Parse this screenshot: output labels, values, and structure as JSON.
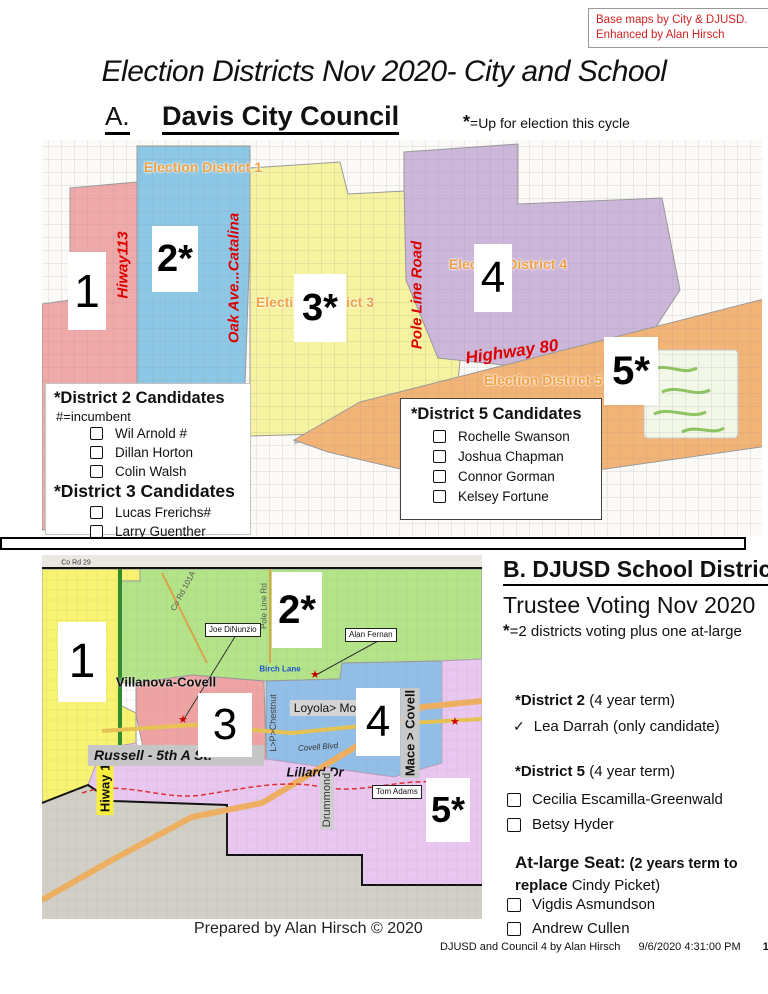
{
  "credit_box": {
    "line1": "Base maps by City & DJUSD.",
    "line2": "Enhanced by Alan Hirsch"
  },
  "title": "Election Districts Nov 2020- City and School",
  "icons": {
    "star": "★",
    "check": "✓"
  },
  "colors": {
    "credit_red": "#cc2222",
    "road_label_red": "#dd0000",
    "area_label_orange": "#f0a143",
    "council_districts": [
      "#efa9a9",
      "#8cc8e6",
      "#f5f2a0",
      "#ccb6da",
      "#f2b376"
    ],
    "school_districts": [
      "#f8f370",
      "#b4e488",
      "#f0a3a3",
      "#92bfe8",
      "#e9c7f0"
    ]
  },
  "section_a": {
    "label": "A.",
    "heading": "Davis City Council",
    "note_star": "*",
    "note": "=Up for election this cycle",
    "map": {
      "district_boxes": [
        "1",
        "2*",
        "3*",
        "4",
        "5*"
      ],
      "area_labels": [
        "Election District 1",
        "Election District 3",
        "Election District 4",
        "Election District 5"
      ],
      "road_labels": [
        "Hiway113",
        "Oak Ave...Catalina",
        "Pole Line Road",
        "Highway 80"
      ]
    },
    "candidates_box_left": {
      "title1": "*District 2 Candidates",
      "legend": "#=incumbent",
      "list1": [
        "Wil Arnold #",
        "Dillan Horton",
        "Colin Walsh"
      ],
      "title2": "*District 3 Candidates",
      "list2": [
        "Lucas Frerichs#",
        "Larry Guenther"
      ]
    },
    "candidates_box_right": {
      "title": "*District 5 Candidates",
      "list": [
        "Rochelle Swanson",
        "Joshua Chapman",
        "Connor Gorman",
        "Kelsey Fortune"
      ]
    }
  },
  "section_b": {
    "heading": "B. DJUSD School District",
    "subheading": "Trustee Voting Nov 2020",
    "note_star": "*",
    "note": "=2 districts voting  plus one at-large",
    "map": {
      "district_boxes": [
        "1",
        "2*",
        "3",
        "4",
        "5*"
      ],
      "area_labels": [
        "Villanova-Covell",
        "Loyola> Monarch"
      ],
      "road_labels": [
        "Hiway 113",
        "Russell - 5th  A St.",
        "Lillard Dr",
        "Mace > Covell",
        "Drummond",
        "L>P>Chestnut",
        "Pole Line Rd",
        "Co Rd 101A",
        "Birch Lane",
        "Covell Blvd",
        "Co Rd 29"
      ],
      "callouts": [
        "Joe DiNunzio",
        "Alan Fernan",
        "Tom Adams"
      ]
    },
    "district2": {
      "title_bold": "*District 2",
      "title_rest": " (4 year term)",
      "candidate": "Lea Darrah (only candidate)"
    },
    "district5": {
      "title_bold": "*District 5",
      "title_rest": " (4 year term)",
      "list": [
        "Cecilia Escamilla-Greenwald",
        "Betsy Hyder"
      ]
    },
    "at_large": {
      "title_bold": "At-large Seat:",
      "term1": " (2 years term to",
      "term2_bold": "replace",
      "term2_rest": " Cindy Picket)",
      "list": [
        "Vigdis Asmundson",
        "Andrew Cullen"
      ]
    }
  },
  "footer": {
    "prepared": "Prepared by Alan Hirsch © 2020",
    "doc_name": "DJUSD and Council 4 by Alan Hirsch",
    "datetime": "9/6/2020 4:31:00 PM",
    "page_num": "1"
  }
}
